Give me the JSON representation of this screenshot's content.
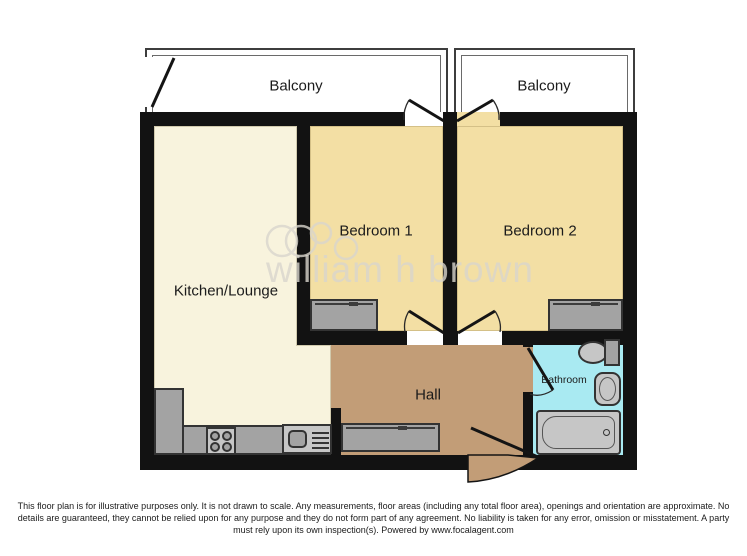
{
  "plan": {
    "labels": {
      "balcony1": "Balcony",
      "balcony2": "Balcony",
      "kitchen": "Kitchen/Lounge",
      "bedroom1": "Bedroom 1",
      "bedroom2": "Bedroom 2",
      "hall": "Hall",
      "bathroom": "Bathroom"
    },
    "watermark_text": "william h brown"
  },
  "colors": {
    "kitchen": "#f8f3dd",
    "bedroom": "#f3dfa4",
    "hall": "#c29d77",
    "bathroom": "#a9eaf2",
    "wall": "#121212",
    "fixture": "#a3a3a3",
    "fixture-light": "#c6c6c6",
    "line": "#333333",
    "balcony-line": "#3d3d3d",
    "label": "#1b1b1b",
    "watermark": "#d9d6cd"
  },
  "disclaimer": {
    "lines": [
      "This floor plan is for illustrative purposes only. It is not drawn to scale. Any measurements, floor areas (including any total floor area), openings and orientation are approximate. No",
      "details are guaranteed, they cannot be relied upon for any purpose and they do not form part of any agreement. No liability is taken for any error, omission or misstatement. A party",
      "must rely upon its own inspection(s). Powered by www.focalagent.com"
    ]
  }
}
